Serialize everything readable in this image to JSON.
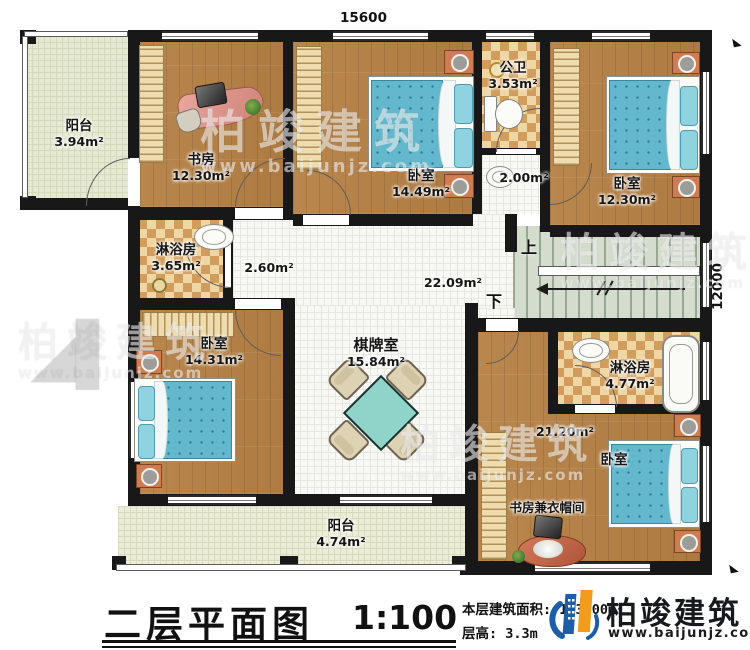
{
  "dimensions": {
    "top": "15600",
    "right": "12000"
  },
  "rooms": {
    "balcony_top": {
      "name": "阳台",
      "area": "3.94m²"
    },
    "study": {
      "name": "书房",
      "area": "12.30m²"
    },
    "bedroom_mid": {
      "name": "卧室",
      "area": "14.49m²"
    },
    "public_bath": {
      "name": "公卫",
      "area": "3.53m²"
    },
    "wash": {
      "area": "2.00m²"
    },
    "bedroom_top_right": {
      "name": "卧室",
      "area": "12.30m²"
    },
    "shower_left": {
      "name": "淋浴房",
      "area": "3.65m²"
    },
    "hall_small": {
      "area": "2.60m²"
    },
    "hall": {
      "area": "22.09m²"
    },
    "bedroom_left": {
      "name": "卧室",
      "area": "14.31m²"
    },
    "game_room": {
      "name": "棋牌室",
      "area": "15.84m²"
    },
    "shower_right": {
      "name": "淋浴房",
      "area": "4.77m²"
    },
    "bedroom_bottom_right": {
      "name": "卧室",
      "area": "21.20m²"
    },
    "study_cloak": {
      "name": "书房兼衣帽间"
    },
    "balcony_bottom": {
      "name": "阳台",
      "area": "4.74m²"
    }
  },
  "stairs": {
    "up": "上",
    "down": "下"
  },
  "titleblock": {
    "title": "二层平面图",
    "scale": "1:100",
    "area_line": "本层建筑面积: 163.00m²",
    "height_line": "层高: 3.3m"
  },
  "brand": {
    "name": "柏竣建筑",
    "url": "www.baijunjz.com"
  },
  "colors": {
    "wall": "#181818",
    "wood": "#b5824a",
    "tile_beige": "#efd7a5",
    "tile_brown": "#d29c5c",
    "bed": "#63b8cd",
    "balcony": "#e5e9d4",
    "stairs": "#d3dccd",
    "logo_blue": "#1c5fa8",
    "logo_orange": "#f29b1d"
  }
}
